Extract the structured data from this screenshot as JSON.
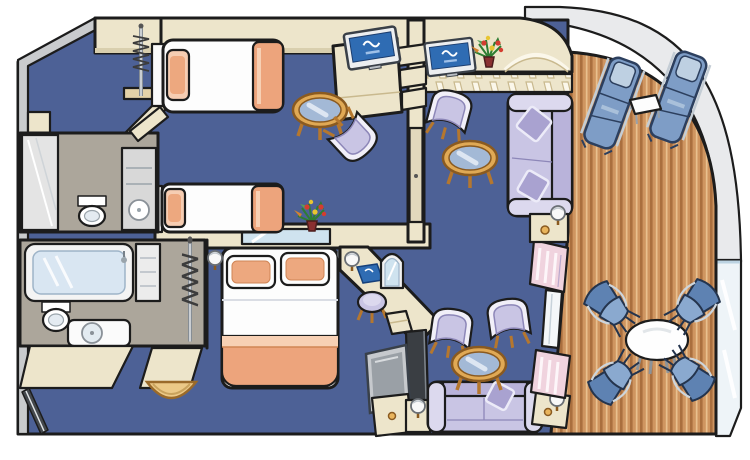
{
  "scene": {
    "type": "floor-plan-illustration",
    "subject": "isometric cartoon floor plan of a two-bedroom cruise-ship suite with curved teak balcony",
    "visible_text": [],
    "projection": "isometric-cartoon"
  },
  "colors": {
    "background": "#ffffff",
    "carpet": "#4d6196",
    "wall_cream": "#ede5cb",
    "wall_edge": "#d9cfae",
    "outline": "#1c1c1c",
    "deck_wood": "#cf9560",
    "deck_plank_dark": "#aa6f3e",
    "deck_plank_light": "#e9c08e",
    "hull_deck_gray": "#e9eaec",
    "outer_wall_gray": "#c9cbcd",
    "glass": "#eef4f8",
    "upholstery_lavender": "#c9c5e4",
    "pillow_lavender": "#a9a2d0",
    "bedding_white": "#fdfdfd",
    "accent_peach": "#eda47c",
    "peach_light": "#f6cdb2",
    "balcony_furniture_blue": "#7e9dc6",
    "tv_screen_blue": "#2f6cb3",
    "wood_trim": "#b5772e",
    "bathroom_floor": "#aca69b",
    "curtain_pink": "#f0d3de",
    "mirror_blue": "#cfe3ef"
  },
  "rooms": [
    {
      "id": "bedroom-1",
      "furniture": [
        "twin-bed-upper",
        "twin-bed-lower",
        "wardrobe-rail-with-hangers",
        "open-closet-door",
        "wall-shelf",
        "tv-cabinet",
        "flat-tv",
        "shelf-steps",
        "round-glass-table",
        "armchair"
      ]
    },
    {
      "id": "bathroom-1",
      "furniture": [
        "shower-stall",
        "toilet",
        "sink-vanity",
        "open-door"
      ]
    },
    {
      "id": "bathroom-2",
      "furniture": [
        "bathtub",
        "shelf-column",
        "toilet",
        "sink-vanity",
        "vanity-apron"
      ]
    },
    {
      "id": "bedroom-2",
      "furniture": [
        "queen-bed",
        "reading-lamp-left",
        "reading-lamp-right",
        "headboard-mirror-strip",
        "flower-vase",
        "vanity-desk",
        "globe-lamp",
        "blue-logo-folder",
        "arched-mirror",
        "stool",
        "drawer-unit",
        "closet-rail-with-hangers",
        "entry-mat-semicircle"
      ]
    },
    {
      "id": "living-room",
      "furniture": [
        "counter-desk-hatched",
        "flat-tv",
        "flower-vase",
        "armchair",
        "round-glass-table",
        "sofa-with-two-pillows",
        "side-cabinet-with-lamp",
        "arched-window",
        "rear-facing-tv",
        "tv-stand-panel",
        "tv-cabinet",
        "sofa-bed",
        "throw-pillow",
        "armchair-left",
        "armchair-right",
        "round-glass-table-2",
        "nightstand-with-lamp-left",
        "nightstand-with-lamp-right",
        "pink-curtain-panel-upper",
        "balcony-door",
        "pink-curtain-panel-lower"
      ]
    },
    {
      "id": "balcony",
      "furniture": [
        "lounger-1",
        "lounger-2",
        "cube-side-table",
        "round-dining-table",
        "deck-chair-top-left",
        "deck-chair-top-right",
        "deck-chair-bottom-left",
        "deck-chair-bottom-right",
        "glass-railing",
        "teak-deck-planks"
      ]
    }
  ],
  "counts": {
    "beds": 3,
    "sofas": 2,
    "tvs": 3,
    "balcony_deck_chairs": 4,
    "loungers": 2,
    "glass_tables": 3,
    "bathrooms": 2,
    "flower_vases": 2,
    "wardrobes": 2
  }
}
